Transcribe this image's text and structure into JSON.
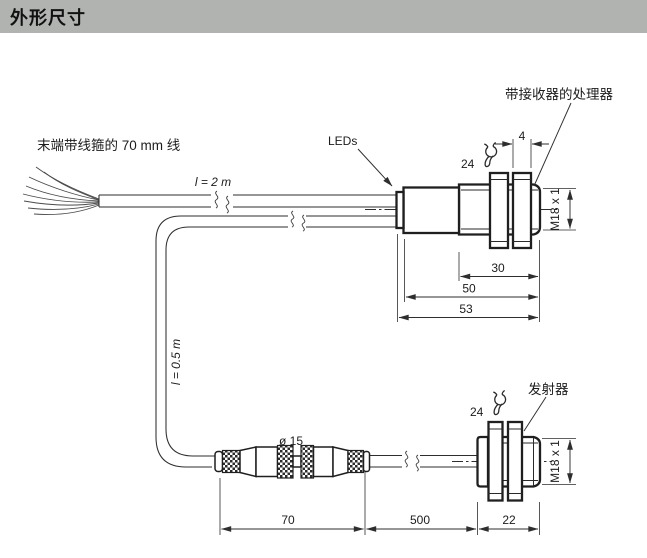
{
  "header": {
    "title": "外形尺寸"
  },
  "top": {
    "wire_note": "末端带线箍的 70 mm 线",
    "cable_length": "l = 2 m",
    "leds_label": "LEDs",
    "receiver_label": "带接收器的处理器",
    "wrench_size": "24",
    "nut_width": "4",
    "thread_spec": "M18 x 1",
    "dim_thread": "30",
    "dim_barrel": "50",
    "dim_total": "53"
  },
  "bottom": {
    "cable_length": "l = 0.5 m",
    "connector_diameter": "ø 15",
    "emitter_label": "发射器",
    "wrench_size": "24",
    "thread_spec": "M18 x 1",
    "dim_connectors": "70",
    "dim_cable": "500",
    "dim_body": "22"
  },
  "colors": {
    "header_bg": "#b1b3b1",
    "line": "#2e2e2e",
    "background": "#ffffff"
  }
}
